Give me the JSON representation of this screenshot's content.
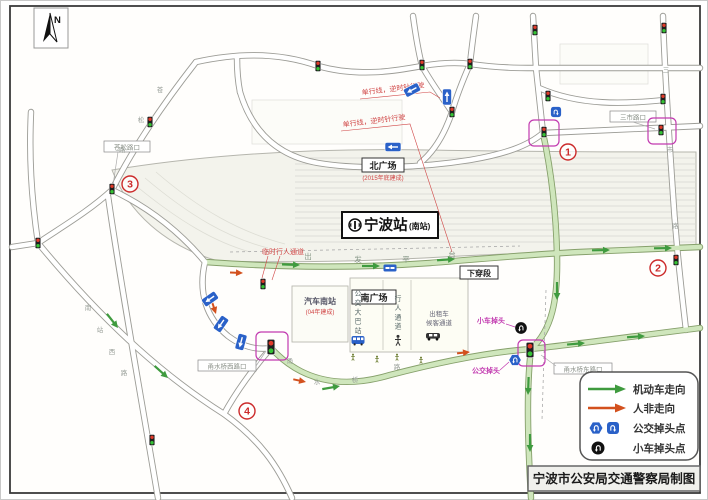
{
  "colors": {
    "motor_flow_green": "#3f9b3f",
    "nonmotor_flow_red": "#d3511e",
    "bus_sign_blue": "#2a61c8",
    "annotation_red": "#d04545",
    "annotation_magenta": "#c23ab0",
    "circled_number_red": "#cc2b2b",
    "road_green_fill": "#cfe6bc"
  },
  "compass": {
    "label": "N"
  },
  "station": {
    "name": "宁波站",
    "suffix": "(南站)"
  },
  "squares": {
    "north": "北广场",
    "north_note": "(2015年底建成)",
    "south": "南广场"
  },
  "facilities": {
    "underpass": "下穿段",
    "coach_station": "汽车南站",
    "coach_station_note": "(04年建成)",
    "departure_platform": "出发平台"
  },
  "channels": {
    "bus": "公交大巴站",
    "pedestrian": "行人通道",
    "taxi_line1": "出租车",
    "taxi_line2": "候客通道"
  },
  "annotations": {
    "one_way_a": "单行线，逆时针行驶",
    "one_way_b": "单行线，逆时针行驶",
    "temp_pedestrian": "临时行人通道",
    "car_uturn": "小车掉头",
    "bus_uturn": "公交掉头"
  },
  "intersections": {
    "cangsong": "苍松路口",
    "sanshi": "三市路口",
    "yongshui_west": "甬水桥西路口",
    "yongshui_east": "甬水桥东路口"
  },
  "circled_numbers": [
    "1",
    "2",
    "3",
    "4"
  ],
  "road_names": {
    "cangsong": "苍松路",
    "yongshuiqiao": "甬水桥路",
    "sanshi": "三市路",
    "nanzhan_west": "南站西路"
  },
  "legend": {
    "items": [
      {
        "icon": "green-arrow",
        "label": "机动车走向"
      },
      {
        "icon": "red-arrow",
        "label": "人非走向"
      },
      {
        "icon": "bus-uturn-badges",
        "label": "公交掉头点"
      },
      {
        "icon": "car-uturn-badge",
        "label": "小车掉头点"
      }
    ]
  },
  "credit": "宁波市公安局交通警察局制图"
}
